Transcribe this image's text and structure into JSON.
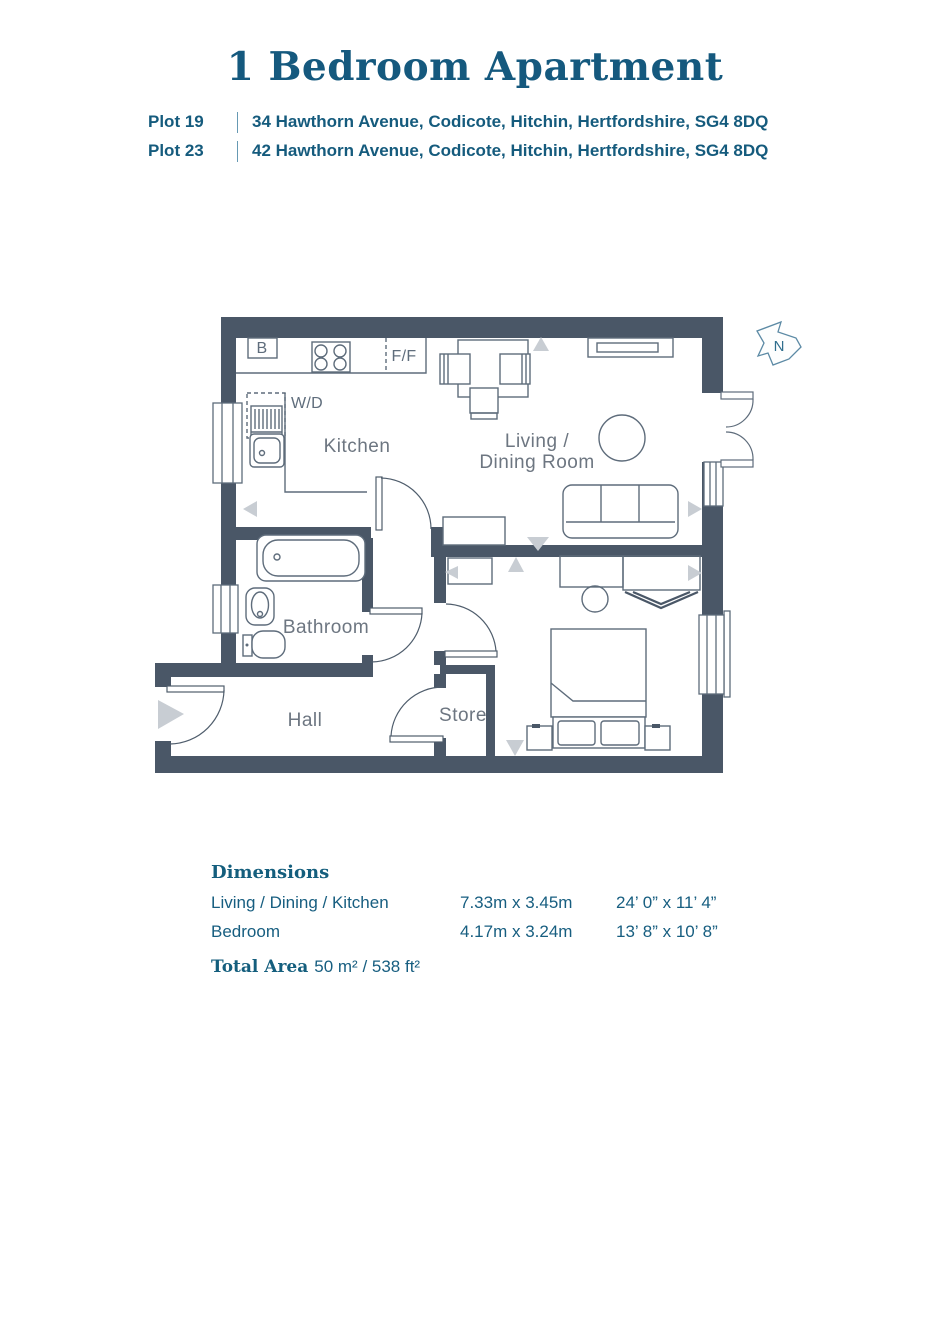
{
  "header": {
    "title": "1 Bedroom Apartment",
    "plots": [
      {
        "plot": "Plot 19",
        "address": "34 Hawthorn Avenue, Codicote, Hitchin, Hertfordshire, SG4 8DQ"
      },
      {
        "plot": "Plot 23",
        "address": "42 Hawthorn Avenue, Codicote, Hitchin, Hertfordshire, SG4 8DQ"
      }
    ]
  },
  "floorplan": {
    "room_labels": {
      "kitchen": "Kitchen",
      "living_line1": "Living /",
      "living_line2": "Dining Room",
      "bathroom": "Bathroom",
      "hall": "Hall",
      "store": "Store"
    },
    "appliance_labels": {
      "boiler": "B",
      "fridge_freezer": "F/F",
      "washer_dryer": "W/D"
    },
    "compass": {
      "north": "N"
    },
    "colors": {
      "wall": "#4a5767",
      "outline": "#5e6c7b",
      "room_label": "#6d7681",
      "marker": "#c8cdd3",
      "accent_text": "#15597e"
    }
  },
  "dimensions": {
    "heading": "Dimensions",
    "rows": [
      {
        "room": "Living / Dining / Kitchen",
        "metric": "7.33m x 3.45m",
        "imperial": "24’ 0” x 11’ 4”"
      },
      {
        "room": "Bedroom",
        "metric": "4.17m x 3.24m",
        "imperial": "13’ 8” x 10’ 8”"
      }
    ],
    "total": {
      "label": "Total Area",
      "value": "50 m² / 538 ft²"
    }
  }
}
